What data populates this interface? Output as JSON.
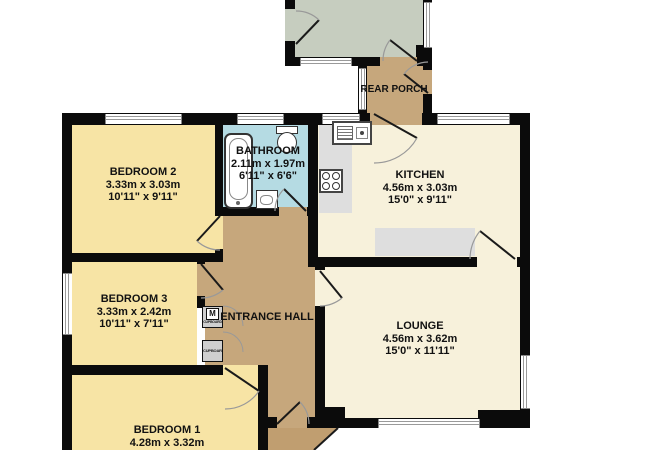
{
  "floorplan": {
    "rooms": {
      "bedroom2": {
        "name": "BEDROOM 2",
        "metric": "3.33m  x 3.03m",
        "imperial": "10'11\"  x 9'11\""
      },
      "bathroom": {
        "name": "BATHROOM",
        "metric": "2.11m  x 1.97m",
        "imperial": "6'11\"  x 6'6\""
      },
      "kitchen": {
        "name": "KITCHEN",
        "metric": "4.56m  x 3.03m",
        "imperial": "15'0\"  x 9'11\""
      },
      "bedroom3": {
        "name": "BEDROOM 3",
        "metric": "3.33m  x 2.42m",
        "imperial": "10'11\"  x 7'11\""
      },
      "lounge": {
        "name": "LOUNGE",
        "metric": "4.56m  x 3.62m",
        "imperial": "15'0\"  x 11'11\""
      },
      "bedroom1": {
        "name": "BEDROOM 1",
        "metric": "4.28m  x 3.32m"
      },
      "entrance_hall": {
        "name": "ENTRANCE HALL"
      },
      "rear_porch": {
        "name": "REAR PORCH"
      }
    },
    "fixtures": {
      "cupboard_top_label": "CUPBOARD",
      "cupboard_bottom_label": "CUPBOARD",
      "boiler_symbol": "M"
    },
    "colors": {
      "bedroom": "#F7E4A5",
      "living": "#F7F1DB",
      "bathroom": "#B5DBE3",
      "hall": "#C6A77C",
      "front_porch": "#C09E70",
      "outbuilding": "#C6CDBF",
      "counter": "#DEDEDE",
      "fixture_gray": "#CFCFCF",
      "wall": "#0B0B0B",
      "window_line": "#9A9A9A",
      "door_arc": "#999999",
      "text": "#111111"
    }
  }
}
